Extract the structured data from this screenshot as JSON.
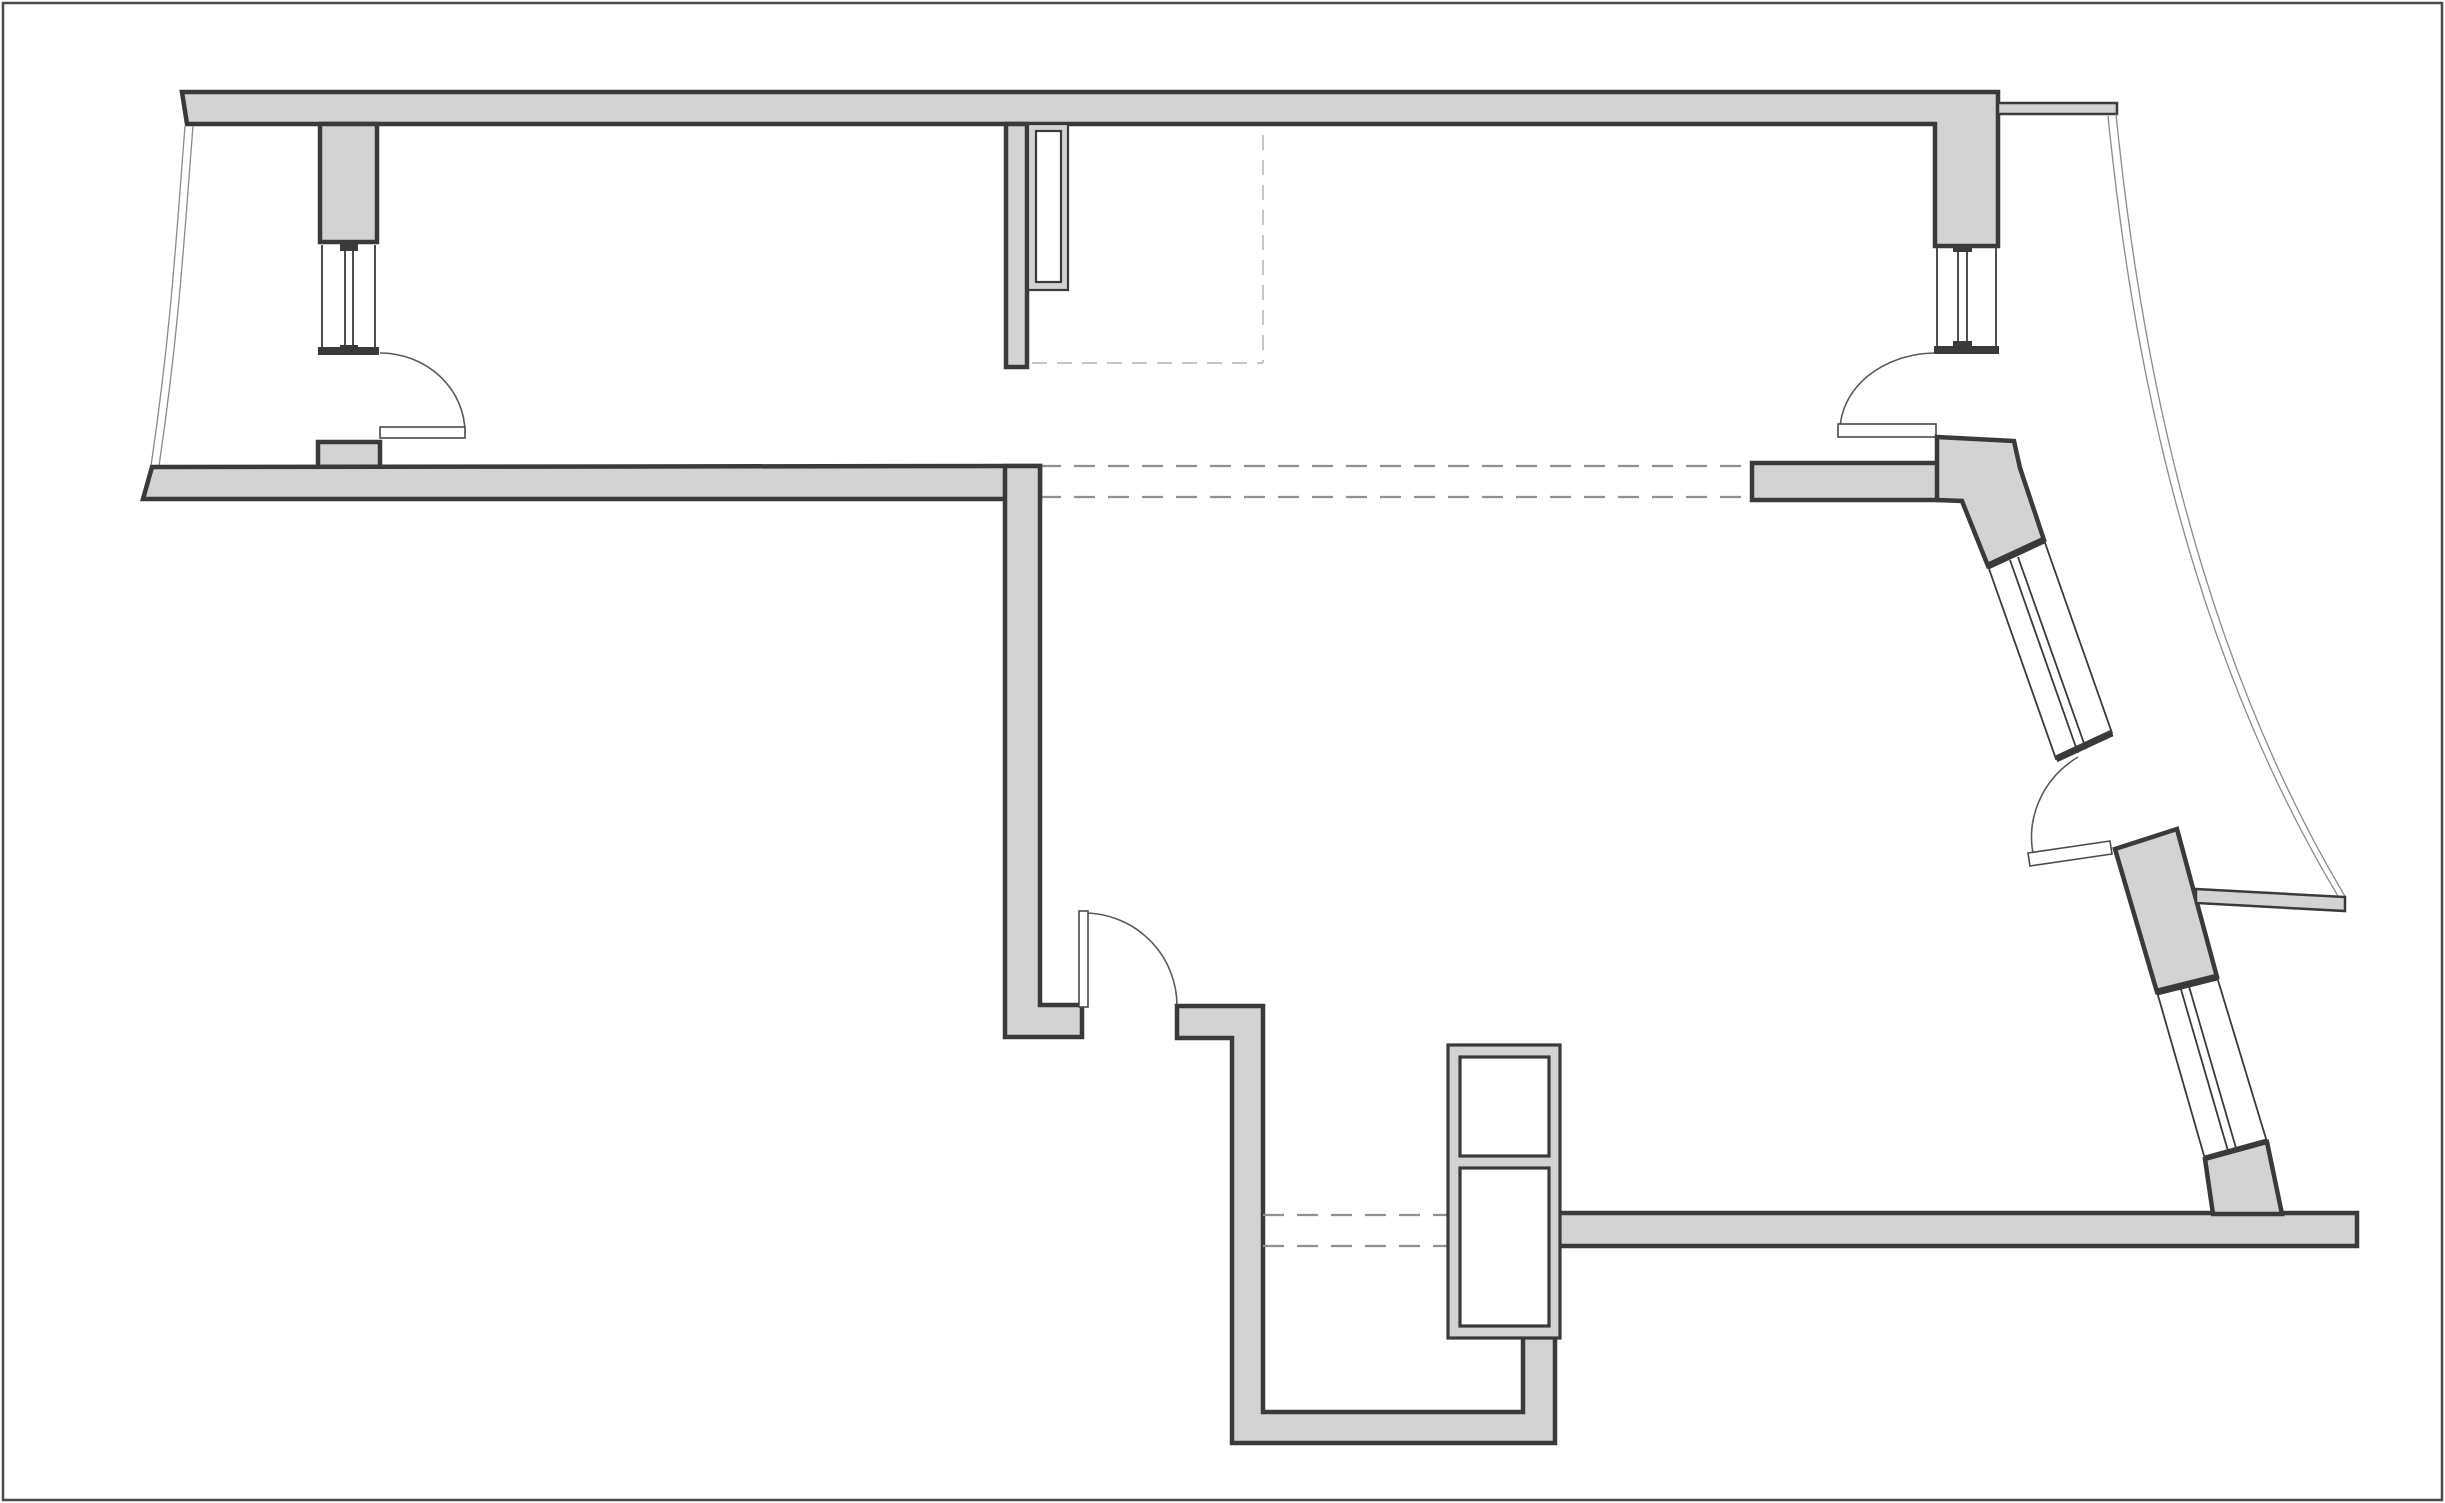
{
  "document": {
    "type": "architectural-floor-plan",
    "description": "black-and-white apartment floor plan line drawing, no text labels"
  },
  "colors": {
    "background": "#ffffff",
    "frame": "#4a4a4a",
    "wall_fill": "#d3d3d3",
    "wall_stroke": "#3a3a3a",
    "window_line": "#3a3a3a",
    "facade_line": "#8a8a8a",
    "dash_light": "#c6c6c6",
    "dash_medium": "#909090"
  },
  "inventory": {
    "exterior_walls": [
      "top-exterior-wall",
      "middle-wall-band",
      "upper-right-wall-band",
      "bay-elbow-wall",
      "bay-middle-pier",
      "bay-bottom-pier",
      "bottom-exterior-wall",
      "lower-left-room-wall"
    ],
    "interior_walls": [
      "hall-closet-pier",
      "corridor-wall",
      "door-jamb-wall"
    ],
    "windows": [
      "left-window",
      "right-window",
      "bay-upper-window",
      "bay-lower-window"
    ],
    "doors": [
      "left-balcony-door",
      "right-room-door",
      "interior-door",
      "bay-door"
    ],
    "dashed_openings": [
      "wardrobe-dashed-outline",
      "corridor-opening-dashes",
      "bottom-opening-dashes"
    ],
    "other": [
      "left-balcony-facade-curve",
      "right-facade-curve",
      "utility-shaft",
      "hall-closet-duct",
      "balcony-parapet-bar",
      "top-right-stub"
    ]
  }
}
